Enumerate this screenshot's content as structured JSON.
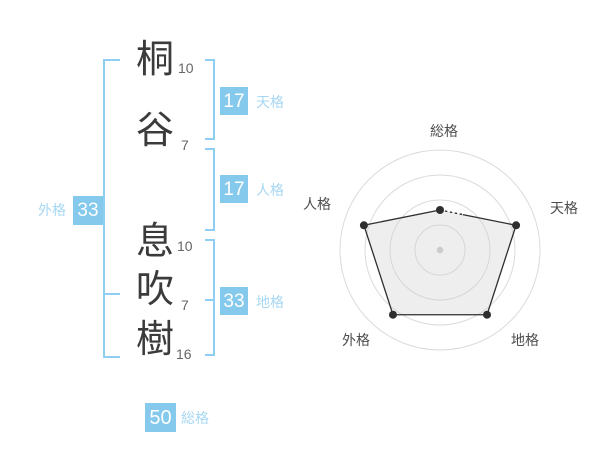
{
  "title": "姓名判断 画数ダイアグラム",
  "name_panel": {
    "characters": [
      {
        "char": "桐",
        "strokes": "10"
      },
      {
        "char": "谷",
        "strokes": "7"
      },
      {
        "char": "息",
        "strokes": "10"
      },
      {
        "char": "吹",
        "strokes": "7"
      },
      {
        "char": "樹",
        "strokes": "16"
      }
    ],
    "kaku": {
      "tenkaku": {
        "label": "天格",
        "value": "17"
      },
      "jinkaku": {
        "label": "人格",
        "value": "17"
      },
      "chikaku": {
        "label": "地格",
        "value": "33"
      },
      "gaikaku": {
        "label": "外格",
        "value": "33"
      },
      "soukaku": {
        "label": "総格",
        "value": "50"
      }
    }
  },
  "colors": {
    "box_blue": "#85c9ec",
    "label_blue": "#a6d7f3",
    "bracket_blue": "#8dcef2",
    "kanji_dark": "#3b3b3b",
    "stroke_gray": "#666666",
    "ring_gray": "#dbdbdb",
    "polygon_dark": "#2e2e2e",
    "center_dot_gray": "#c9c9c9"
  },
  "chart_data": {
    "type": "radar",
    "title": "",
    "axes": [
      "総格",
      "天格",
      "地格",
      "外格",
      "人格"
    ],
    "values": [
      40,
      80,
      80,
      80,
      80
    ],
    "axis_kaku_values": [
      50,
      17,
      33,
      33,
      17
    ],
    "scale": {
      "min": 0,
      "max": 100,
      "ring_step": 25,
      "rings": 4
    },
    "grid_shape": "circle",
    "grid_on": true,
    "legend": "none",
    "style": {
      "stroke": "#2e2e2e",
      "fill": "#cfcfcf",
      "fill_opacity": 0.35,
      "point_color": "#2e2e2e",
      "ring_color": "#dbdbdb",
      "center_dot_color": "#c9c9c9",
      "first_segment_partially_dashed": true
    }
  }
}
